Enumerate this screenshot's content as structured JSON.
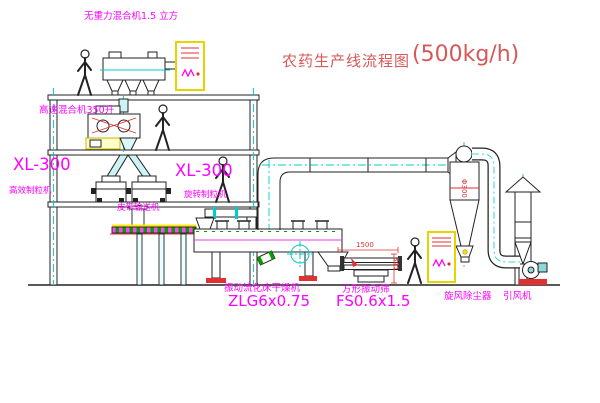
{
  "title": {
    "name": "农药生产线流程图",
    "capacity": "(500kg/h)"
  },
  "labels": {
    "gravity_free_mixer": "无重力混合机1.5 立方",
    "high_speed_mixer": "高速混合机350升",
    "granulator_left_model": "XL-300",
    "granulator_left_name": "高效制粒机",
    "granulator_right_model": "XL-300",
    "granulator_right_name": "旋转制粒机",
    "belt_conveyor": "皮带输送机",
    "fluid_bed_dryer_name": "振动流化床干燥机",
    "fluid_bed_dryer_model": "ZLG6x0.75",
    "vibrating_sieve_name": "方形振动筛",
    "vibrating_sieve_model": "FS0.6x1.5",
    "cyclone_dust_collector": "旋风除尘器",
    "induced_draft_fan": "引风机"
  },
  "dimensions": {
    "sieve_length": "1500",
    "sieve_height": "341",
    "cyclone_pipe": "Φ300"
  },
  "colors": {
    "label_magenta": "#ff00ff",
    "title_red": "#d85858",
    "dimension_red": "#e03030",
    "centerline_cyan": "#00cccc",
    "cabinet_yellow": "#e6d400",
    "line_black": "#222222",
    "background": "#ffffff"
  }
}
